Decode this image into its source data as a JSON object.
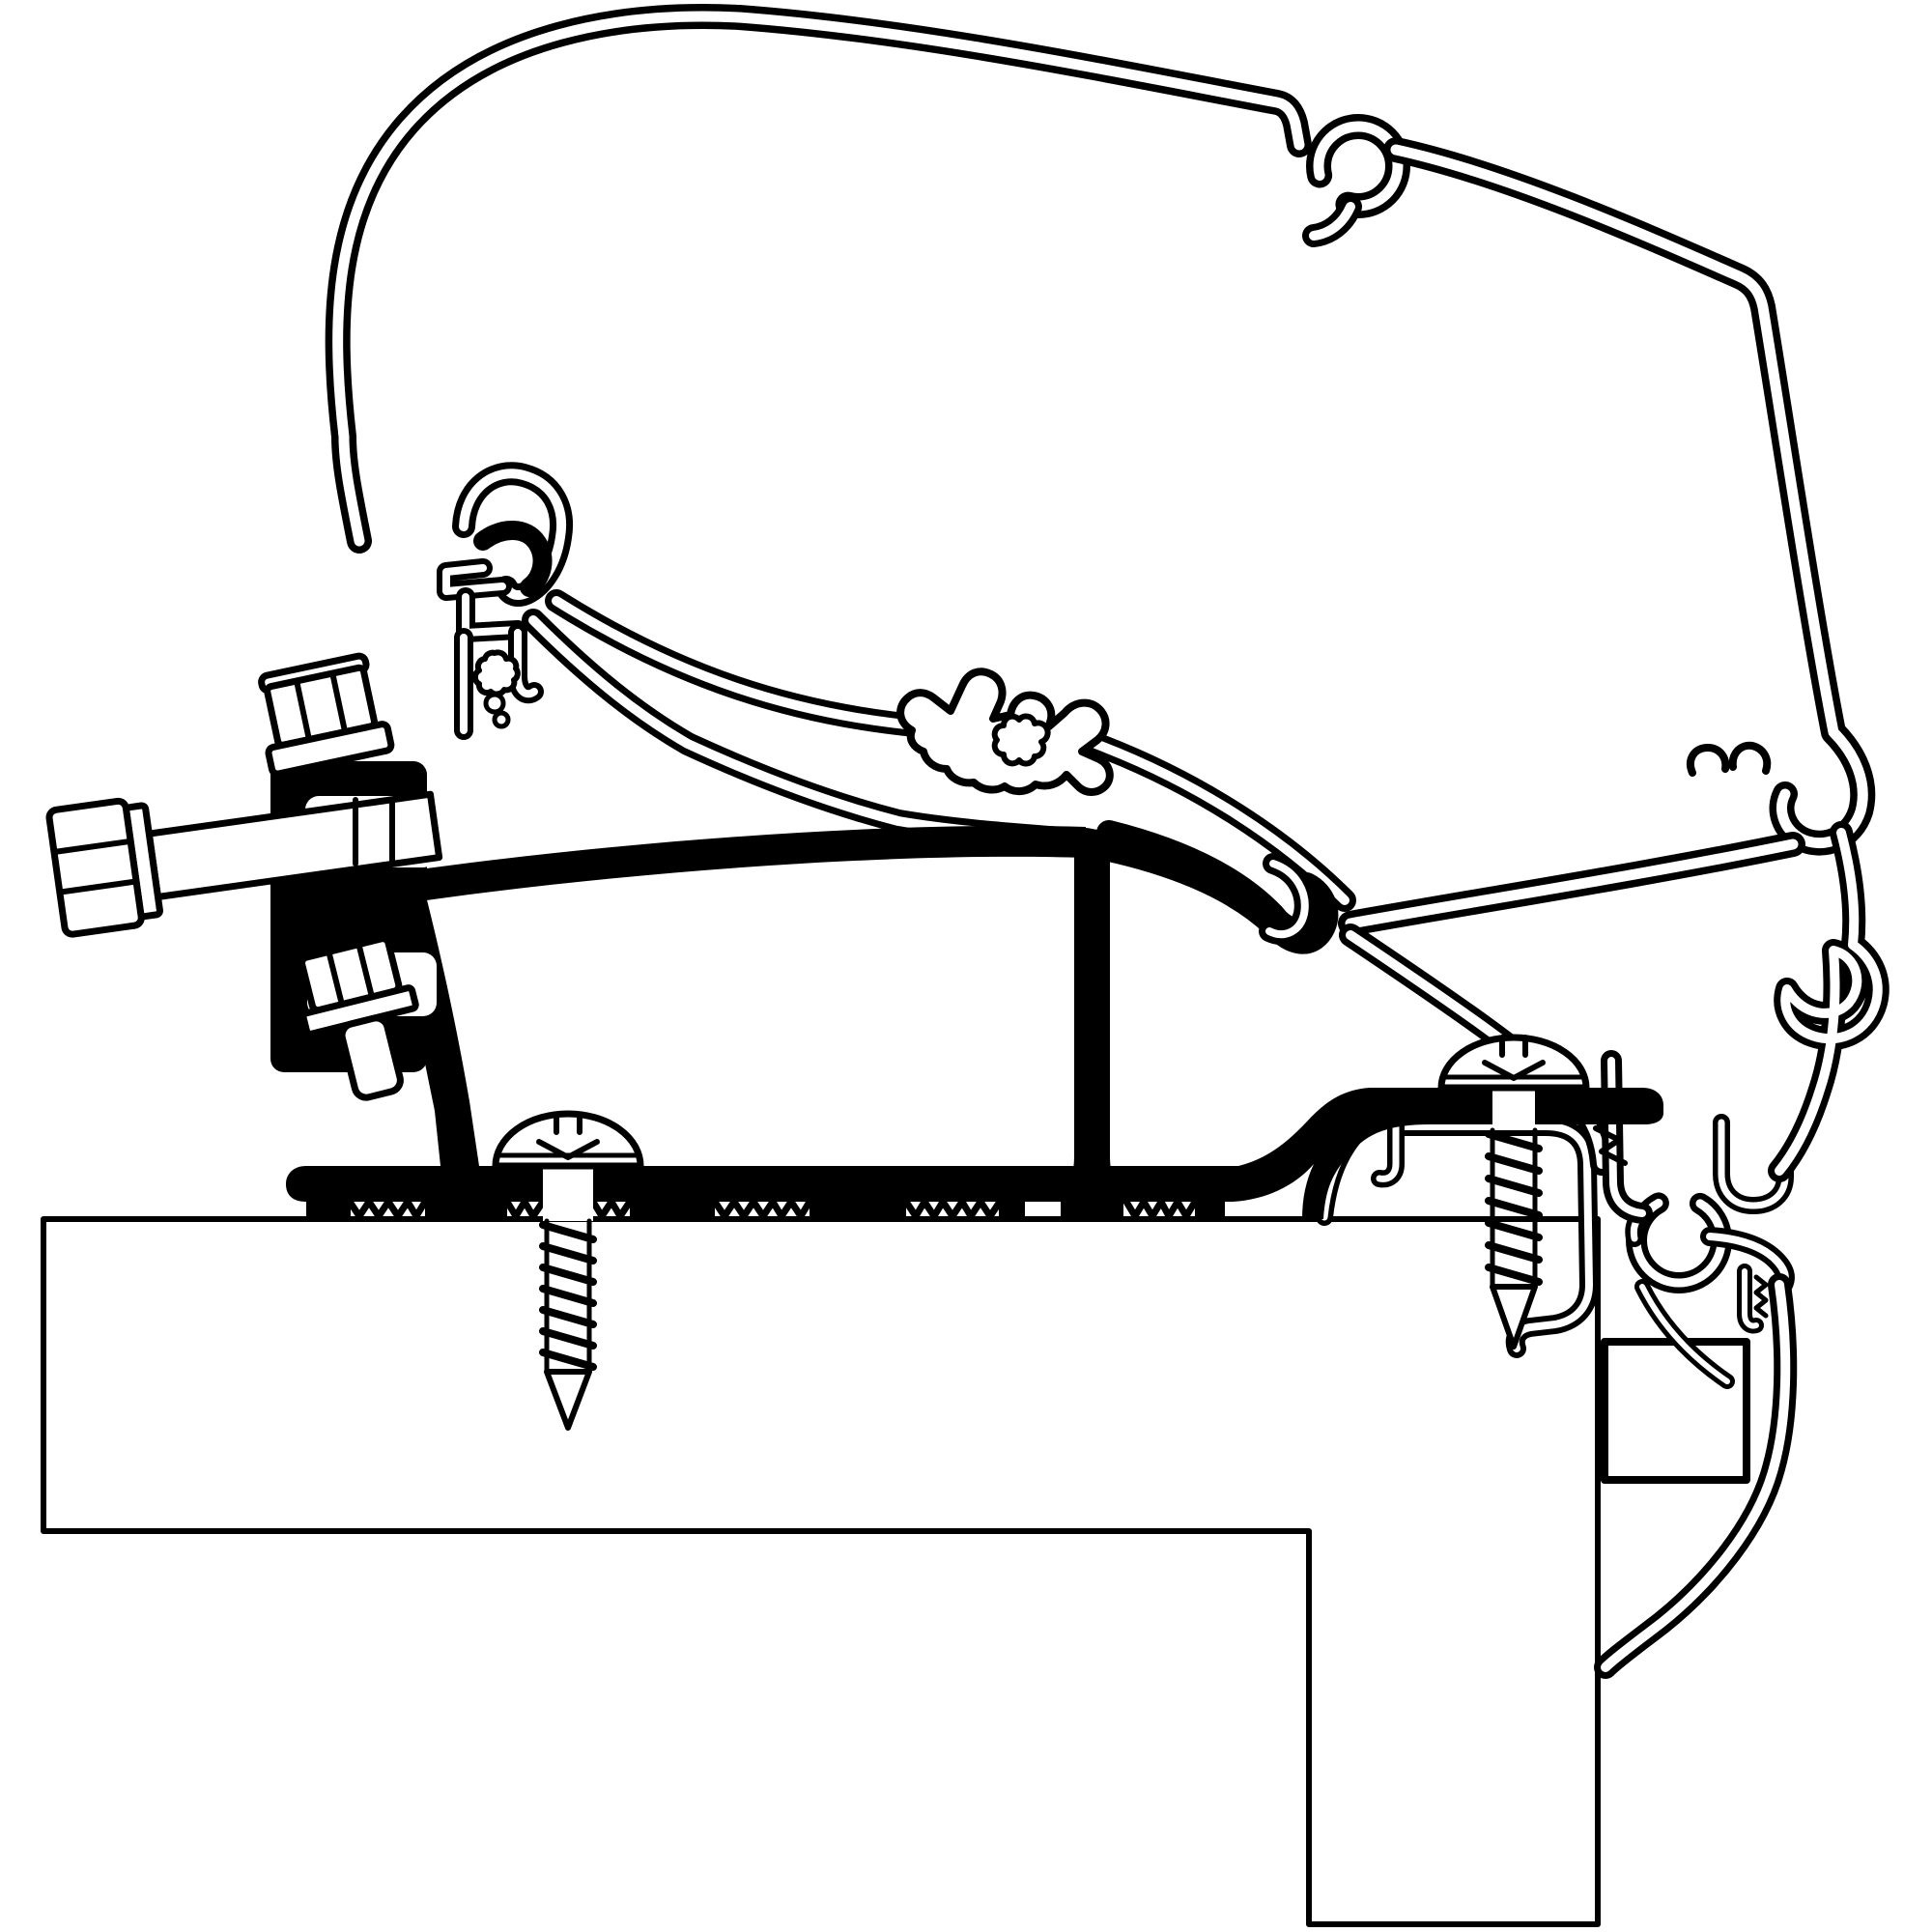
{
  "colors": {
    "ink": "#000000",
    "paper": "#ffffff"
  },
  "diagram": {
    "type": "technical-cross-section",
    "subject": "awning-roof-mount-adapter",
    "parts": [
      "awning-case-profile",
      "case-keyhole-channel",
      "case-left-hook",
      "gasket-crown-channel",
      "mounting-rail",
      "adapter-top-bar",
      "adapter-hook",
      "adapter-stem",
      "adapter-strut",
      "adapter-base-plate",
      "serrated-feet",
      "clamp-block",
      "horizontal-hex-bolt",
      "top-hex-bolt",
      "lower-hex-bolt",
      "left-pan-screw",
      "right-pan-screw",
      "roof-panel",
      "wall-panel",
      "roof-edge-trim",
      "spacer-pad",
      "rain-gutter-profile"
    ]
  }
}
